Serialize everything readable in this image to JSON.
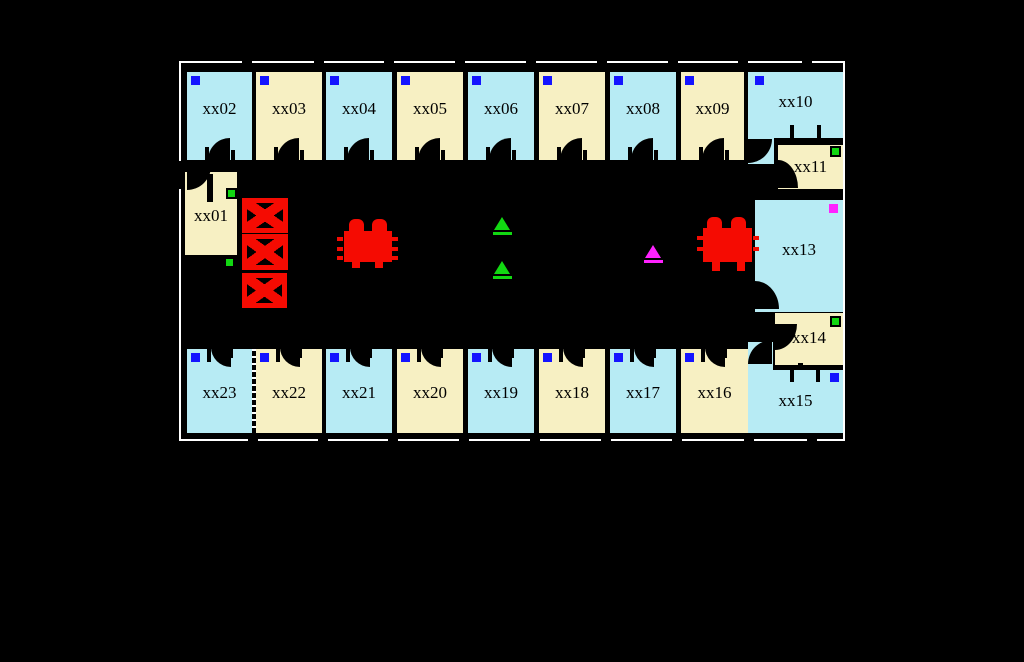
{
  "title": "Floor plan with rooms xx01-xx23",
  "colors": {
    "background": "#000000",
    "wall": "#000000",
    "outline": "#ffffff",
    "room_blue": "#b7ebf4",
    "room_yellow": "#f7f0c3",
    "furniture_red": "#f50b02",
    "marker_blue": "#1414ff",
    "marker_green": "#12d812",
    "marker_magenta": "#ff22ff",
    "label": "#000000"
  },
  "frame": {
    "x": 179,
    "y": 61,
    "w": 666,
    "h": 380
  },
  "rooms": [
    {
      "id": "xx01",
      "label": "xx01",
      "x": 185,
      "y": 172,
      "w": 52,
      "h": 83,
      "color": "yellow",
      "label_dy": 35,
      "marker": {
        "kind": "green-square",
        "dx": 41,
        "dy": 16
      },
      "pies": [
        {
          "x": 187,
          "y": 166,
          "w": 24,
          "h": 24,
          "r": "0 0 100% 0"
        }
      ],
      "walls": [
        {
          "x": 207,
          "y": 174,
          "w": 6,
          "h": 28
        }
      ]
    },
    {
      "id": "xx02",
      "label": "xx02",
      "x": 187,
      "y": 72,
      "w": 65,
      "h": 88,
      "color": "blue",
      "label_dy": 28,
      "door": "bottom",
      "marker": {
        "kind": "blue-square",
        "dx": 4,
        "dy": 4
      }
    },
    {
      "id": "xx03",
      "label": "xx03",
      "x": 256,
      "y": 72,
      "w": 66,
      "h": 88,
      "color": "yellow",
      "label_dy": 28,
      "door": "bottom",
      "marker": {
        "kind": "blue-square",
        "dx": 4,
        "dy": 4
      }
    },
    {
      "id": "xx04",
      "label": "xx04",
      "x": 326,
      "y": 72,
      "w": 66,
      "h": 88,
      "color": "blue",
      "label_dy": 28,
      "door": "bottom",
      "marker": {
        "kind": "blue-square",
        "dx": 4,
        "dy": 4
      }
    },
    {
      "id": "xx05",
      "label": "xx05",
      "x": 397,
      "y": 72,
      "w": 66,
      "h": 88,
      "color": "yellow",
      "label_dy": 28,
      "door": "bottom",
      "marker": {
        "kind": "blue-square",
        "dx": 4,
        "dy": 4
      }
    },
    {
      "id": "xx06",
      "label": "xx06",
      "x": 468,
      "y": 72,
      "w": 66,
      "h": 88,
      "color": "blue",
      "label_dy": 28,
      "door": "bottom",
      "marker": {
        "kind": "blue-square",
        "dx": 4,
        "dy": 4
      }
    },
    {
      "id": "xx07",
      "label": "xx07",
      "x": 539,
      "y": 72,
      "w": 66,
      "h": 88,
      "color": "yellow",
      "label_dy": 28,
      "door": "bottom",
      "marker": {
        "kind": "blue-square",
        "dx": 4,
        "dy": 4
      }
    },
    {
      "id": "xx08",
      "label": "xx08",
      "x": 610,
      "y": 72,
      "w": 66,
      "h": 88,
      "color": "blue",
      "label_dy": 28,
      "door": "bottom",
      "marker": {
        "kind": "blue-square",
        "dx": 4,
        "dy": 4
      }
    },
    {
      "id": "xx09",
      "label": "xx09",
      "x": 681,
      "y": 72,
      "w": 63,
      "h": 88,
      "color": "yellow",
      "label_dy": 28,
      "door": "bottom",
      "marker": {
        "kind": "blue-square",
        "dx": 4,
        "dy": 4
      }
    },
    {
      "id": "xx10",
      "label": "xx10",
      "x": 748,
      "y": 72,
      "w": 95,
      "h": 66,
      "color": "blue",
      "label_dy": 21,
      "marker": {
        "kind": "blue-square",
        "dx": 7,
        "dy": 4
      },
      "extras": [
        {
          "x": 748,
          "y": 138,
          "w": 26,
          "h": 26
        }
      ],
      "pies": [
        {
          "x": 748,
          "y": 139,
          "w": 24,
          "h": 24,
          "r": "0 0 100% 0"
        }
      ],
      "walls": [
        {
          "x": 790,
          "y": 125,
          "w": 4,
          "h": 15
        },
        {
          "x": 817,
          "y": 125,
          "w": 4,
          "h": 15
        }
      ]
    },
    {
      "id": "xx11",
      "label": "xx11",
      "x": 778,
      "y": 145,
      "w": 65,
      "h": 44,
      "color": "yellow",
      "label_dy": 13,
      "marker": {
        "kind": "green-square",
        "dx": 52,
        "dy": 1
      },
      "pies": [
        {
          "x": 778,
          "y": 160,
          "w": 20,
          "h": 28,
          "r": "0 100% 0 0"
        }
      ]
    },
    {
      "id": "xx13",
      "label": "xx13",
      "x": 755,
      "y": 200,
      "w": 88,
      "h": 112,
      "color": "blue",
      "label_dy": 41,
      "marker": {
        "kind": "magenta-square",
        "dx": 74,
        "dy": 4
      },
      "pies": [
        {
          "x": 755,
          "y": 281,
          "w": 24,
          "h": 28,
          "r": "0 100% 0 0"
        }
      ]
    },
    {
      "id": "xx14",
      "label": "xx14",
      "x": 775,
      "y": 313,
      "w": 68,
      "h": 52,
      "color": "yellow",
      "label_dy": 16,
      "marker": {
        "kind": "green-square",
        "dx": 55,
        "dy": 3
      },
      "pies": [
        {
          "x": 775,
          "y": 324,
          "w": 22,
          "h": 26,
          "r": "0 0 100% 0"
        }
      ],
      "walls": [
        {
          "x": 798,
          "y": 363,
          "w": 5,
          "h": 15
        }
      ]
    },
    {
      "id": "xx15",
      "label": "xx15",
      "x": 748,
      "y": 370,
      "w": 95,
      "h": 63,
      "color": "blue",
      "label_dy": 22,
      "marker": {
        "kind": "blue-square",
        "dx": 82,
        "dy": 3
      },
      "extras": [
        {
          "x": 748,
          "y": 342,
          "w": 25,
          "h": 28
        }
      ],
      "pies": [
        {
          "x": 748,
          "y": 340,
          "w": 24,
          "h": 24,
          "r": "100% 0 0 0"
        }
      ],
      "walls": [
        {
          "x": 790,
          "y": 368,
          "w": 4,
          "h": 14
        },
        {
          "x": 816,
          "y": 368,
          "w": 4,
          "h": 14
        }
      ]
    },
    {
      "id": "xx16",
      "label": "xx16",
      "x": 681,
      "y": 349,
      "w": 67,
      "h": 84,
      "color": "yellow",
      "label_dy": 35,
      "door": "top",
      "marker": {
        "kind": "blue-square",
        "dx": 4,
        "dy": 4
      }
    },
    {
      "id": "xx17",
      "label": "xx17",
      "x": 610,
      "y": 349,
      "w": 66,
      "h": 84,
      "color": "blue",
      "label_dy": 35,
      "door": "top",
      "marker": {
        "kind": "blue-square",
        "dx": 4,
        "dy": 4
      }
    },
    {
      "id": "xx18",
      "label": "xx18",
      "x": 539,
      "y": 349,
      "w": 66,
      "h": 84,
      "color": "yellow",
      "label_dy": 35,
      "door": "top",
      "marker": {
        "kind": "blue-square",
        "dx": 4,
        "dy": 4
      }
    },
    {
      "id": "xx19",
      "label": "xx19",
      "x": 468,
      "y": 349,
      "w": 66,
      "h": 84,
      "color": "blue",
      "label_dy": 35,
      "door": "top",
      "marker": {
        "kind": "blue-square",
        "dx": 4,
        "dy": 4
      }
    },
    {
      "id": "xx20",
      "label": "xx20",
      "x": 397,
      "y": 349,
      "w": 66,
      "h": 84,
      "color": "yellow",
      "label_dy": 35,
      "door": "top",
      "marker": {
        "kind": "blue-square",
        "dx": 4,
        "dy": 4
      }
    },
    {
      "id": "xx21",
      "label": "xx21",
      "x": 326,
      "y": 349,
      "w": 66,
      "h": 84,
      "color": "blue",
      "label_dy": 35,
      "door": "top",
      "marker": {
        "kind": "blue-square",
        "dx": 4,
        "dy": 4
      }
    },
    {
      "id": "xx22",
      "label": "xx22",
      "x": 256,
      "y": 349,
      "w": 66,
      "h": 84,
      "color": "yellow",
      "label_dy": 35,
      "door": "top",
      "marker": {
        "kind": "blue-square",
        "dx": 4,
        "dy": 4
      }
    },
    {
      "id": "xx23",
      "label": "xx23",
      "x": 187,
      "y": 349,
      "w": 65,
      "h": 84,
      "color": "blue",
      "label_dy": 35,
      "door": "top",
      "dashed_right": true,
      "marker": {
        "kind": "blue-square",
        "dx": 4,
        "dy": 4
      }
    }
  ],
  "corridor": {
    "elevators": [
      {
        "x": 242,
        "y": 198,
        "w": 46,
        "h": 35
      },
      {
        "x": 242,
        "y": 234,
        "w": 46,
        "h": 36
      },
      {
        "x": 242,
        "y": 273,
        "w": 45,
        "h": 35
      }
    ],
    "tables": [
      {
        "id": "table-left",
        "body": [
          344,
          231,
          48,
          31
        ],
        "bumps": [
          [
            349,
            219
          ],
          [
            372,
            219
          ]
        ],
        "feet": [
          [
            352,
            262,
            8,
            6
          ],
          [
            375,
            262,
            8,
            6
          ]
        ],
        "ticks": [
          [
            337,
            237
          ],
          [
            337,
            247
          ],
          [
            337,
            256
          ],
          [
            392,
            237
          ],
          [
            392,
            247
          ],
          [
            392,
            256
          ]
        ]
      },
      {
        "id": "table-right",
        "body": [
          703,
          228,
          49,
          34
        ],
        "bumps": [
          [
            707,
            217
          ],
          [
            731,
            217
          ]
        ],
        "feet": [
          [
            712,
            262,
            8,
            9
          ],
          [
            737,
            262,
            8,
            9
          ]
        ],
        "ticks": [
          [
            697,
            236
          ],
          [
            697,
            247
          ],
          [
            753,
            236
          ],
          [
            753,
            247
          ]
        ]
      }
    ],
    "triangles": [
      {
        "color": "green",
        "x": 494,
        "y": 217
      },
      {
        "color": "green",
        "x": 494,
        "y": 261
      },
      {
        "color": "magenta",
        "x": 645,
        "y": 245
      }
    ],
    "loose_markers": [
      {
        "kind": "green-square",
        "x": 224,
        "y": 257
      }
    ]
  },
  "exterior": {
    "stubs_top": {
      "y": 56,
      "h": 12,
      "w": 10,
      "xs": [
        242,
        314,
        384,
        455,
        526,
        597,
        668,
        738,
        802
      ]
    },
    "stubs_bottom": {
      "y": 433,
      "h": 13,
      "w": 10,
      "xs": [
        248,
        318,
        388,
        459,
        530,
        601,
        672,
        744,
        807
      ]
    },
    "stub_left": {
      "x": 175,
      "y": 161,
      "w": 8,
      "h": 28
    }
  }
}
